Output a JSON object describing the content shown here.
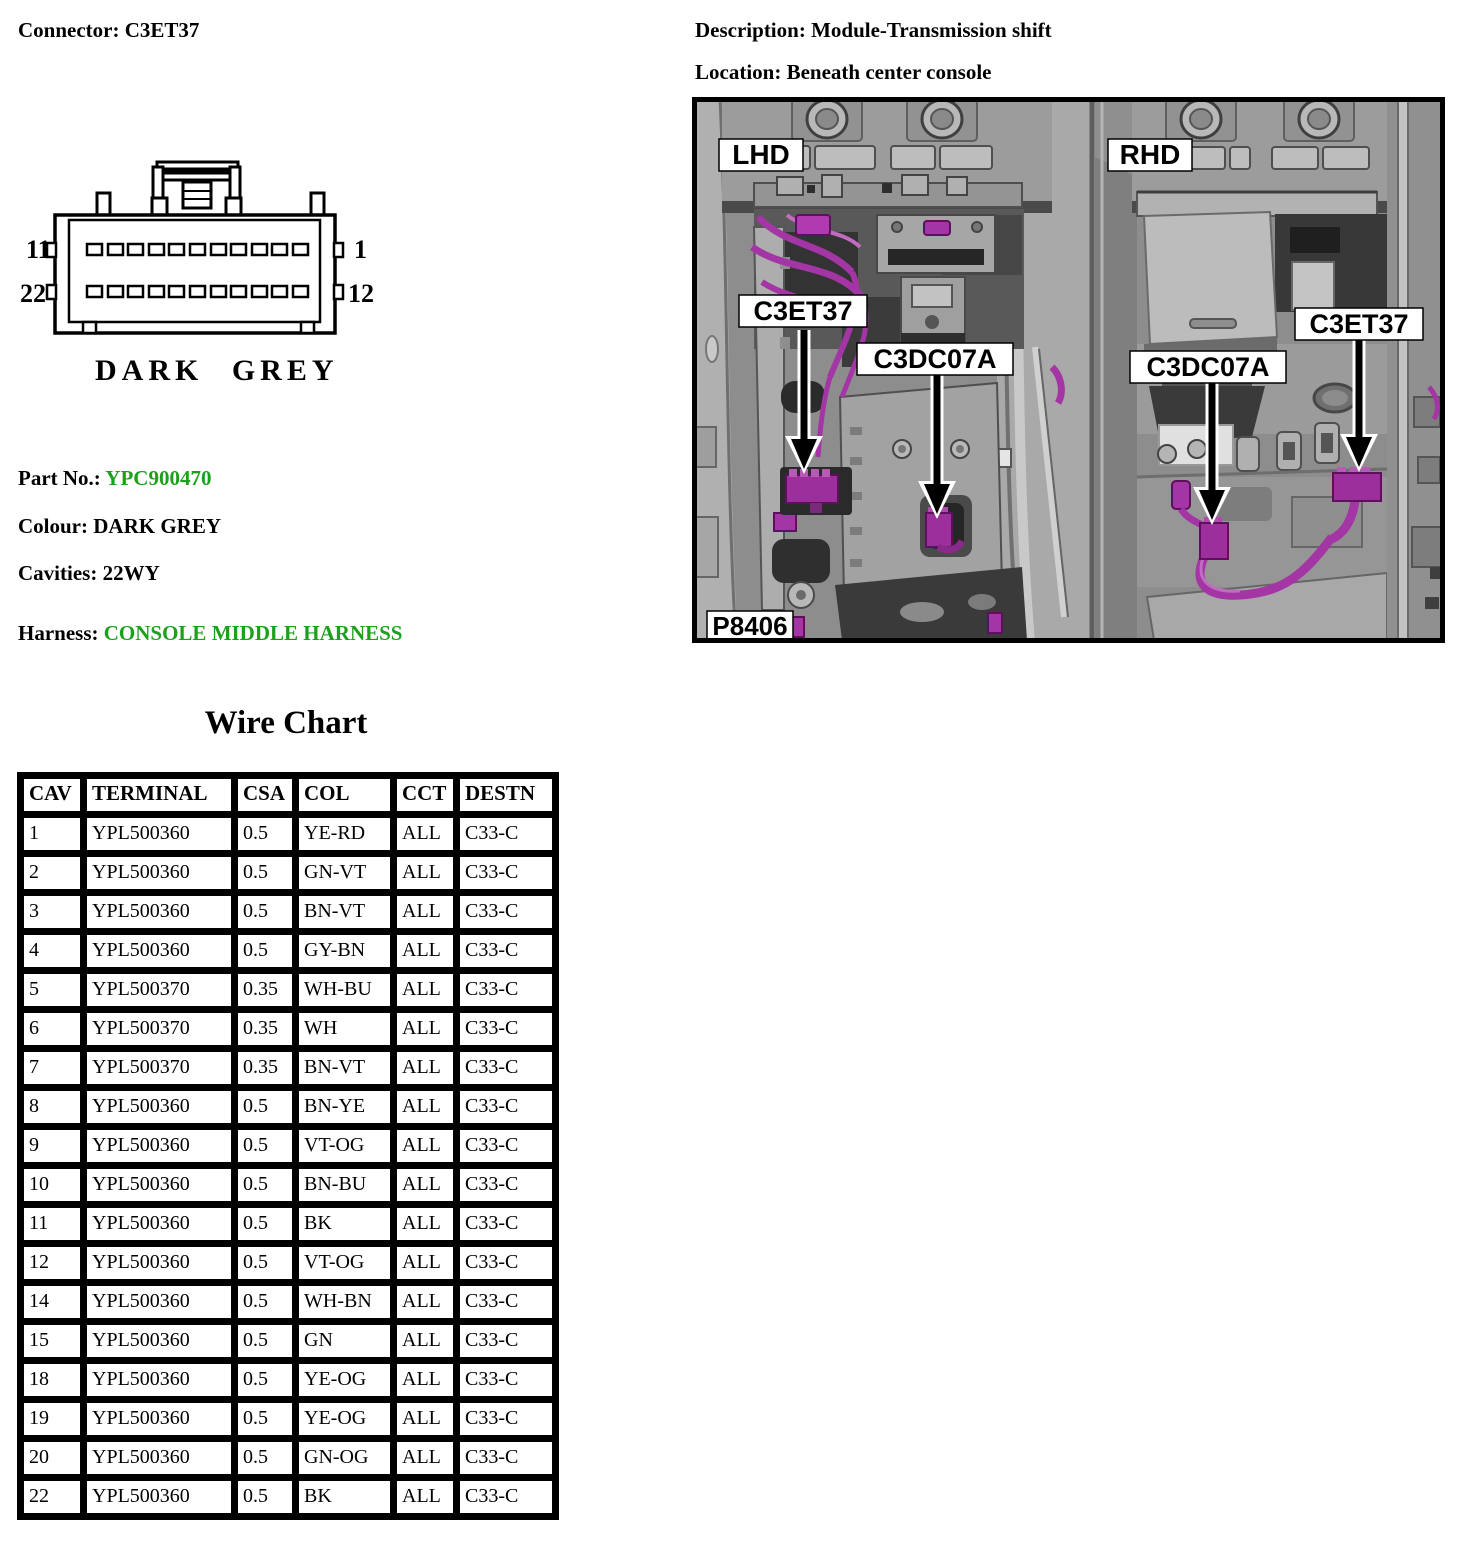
{
  "header": {
    "connector_label": "Connector:",
    "connector_value": "C3ET37",
    "description_label": "Description:",
    "description_value": "Module-Transmission shift",
    "location_label": "Location:",
    "location_value": "Beneath center console"
  },
  "connector_diagram": {
    "pin_top_left": "11",
    "pin_top_right": "1",
    "pin_bottom_left": "22",
    "pin_bottom_right": "12",
    "caption": "DARK GREY"
  },
  "part_info": {
    "part_no_label": "Part No.:",
    "part_no_value": "YPC900470",
    "colour_label": "Colour:",
    "colour_value": "DARK GREY",
    "cavities_label": "Cavities:",
    "cavities_value": "22WY",
    "harness_label": "Harness:",
    "harness_value": "CONSOLE MIDDLE HARNESS"
  },
  "colors": {
    "accent_green": "#1BA11B",
    "harness_magenta": "#A435A4",
    "photo_background": "#8D8D8D"
  },
  "photo": {
    "label_lhd": "LHD",
    "label_rhd": "RHD",
    "label_c3et37_left": "C3ET37",
    "label_c3dc07a_left": "C3DC07A",
    "label_c3dc07a_right": "C3DC07A",
    "label_c3et37_right": "C3ET37",
    "figure_number": "P8406"
  },
  "wire_chart": {
    "title": "Wire Chart",
    "columns": [
      "CAV",
      "TERMINAL",
      "CSA",
      "COL",
      "CCT",
      "DESTN"
    ],
    "rows": [
      [
        "1",
        "YPL500360",
        "0.5",
        "YE-RD",
        "ALL",
        "C33-C"
      ],
      [
        "2",
        "YPL500360",
        "0.5",
        "GN-VT",
        "ALL",
        "C33-C"
      ],
      [
        "3",
        "YPL500360",
        "0.5",
        "BN-VT",
        "ALL",
        "C33-C"
      ],
      [
        "4",
        "YPL500360",
        "0.5",
        "GY-BN",
        "ALL",
        "C33-C"
      ],
      [
        "5",
        "YPL500370",
        "0.35",
        "WH-BU",
        "ALL",
        "C33-C"
      ],
      [
        "6",
        "YPL500370",
        "0.35",
        "WH",
        "ALL",
        "C33-C"
      ],
      [
        "7",
        "YPL500370",
        "0.35",
        "BN-VT",
        "ALL",
        "C33-C"
      ],
      [
        "8",
        "YPL500360",
        "0.5",
        "BN-YE",
        "ALL",
        "C33-C"
      ],
      [
        "9",
        "YPL500360",
        "0.5",
        "VT-OG",
        "ALL",
        "C33-C"
      ],
      [
        "10",
        "YPL500360",
        "0.5",
        "BN-BU",
        "ALL",
        "C33-C"
      ],
      [
        "11",
        "YPL500360",
        "0.5",
        "BK",
        "ALL",
        "C33-C"
      ],
      [
        "12",
        "YPL500360",
        "0.5",
        "VT-OG",
        "ALL",
        "C33-C"
      ],
      [
        "14",
        "YPL500360",
        "0.5",
        "WH-BN",
        "ALL",
        "C33-C"
      ],
      [
        "15",
        "YPL500360",
        "0.5",
        "GN",
        "ALL",
        "C33-C"
      ],
      [
        "18",
        "YPL500360",
        "0.5",
        "YE-OG",
        "ALL",
        "C33-C"
      ],
      [
        "19",
        "YPL500360",
        "0.5",
        "YE-OG",
        "ALL",
        "C33-C"
      ],
      [
        "20",
        "YPL500360",
        "0.5",
        "GN-OG",
        "ALL",
        "C33-C"
      ],
      [
        "22",
        "YPL500360",
        "0.5",
        "BK",
        "ALL",
        "C33-C"
      ]
    ]
  }
}
